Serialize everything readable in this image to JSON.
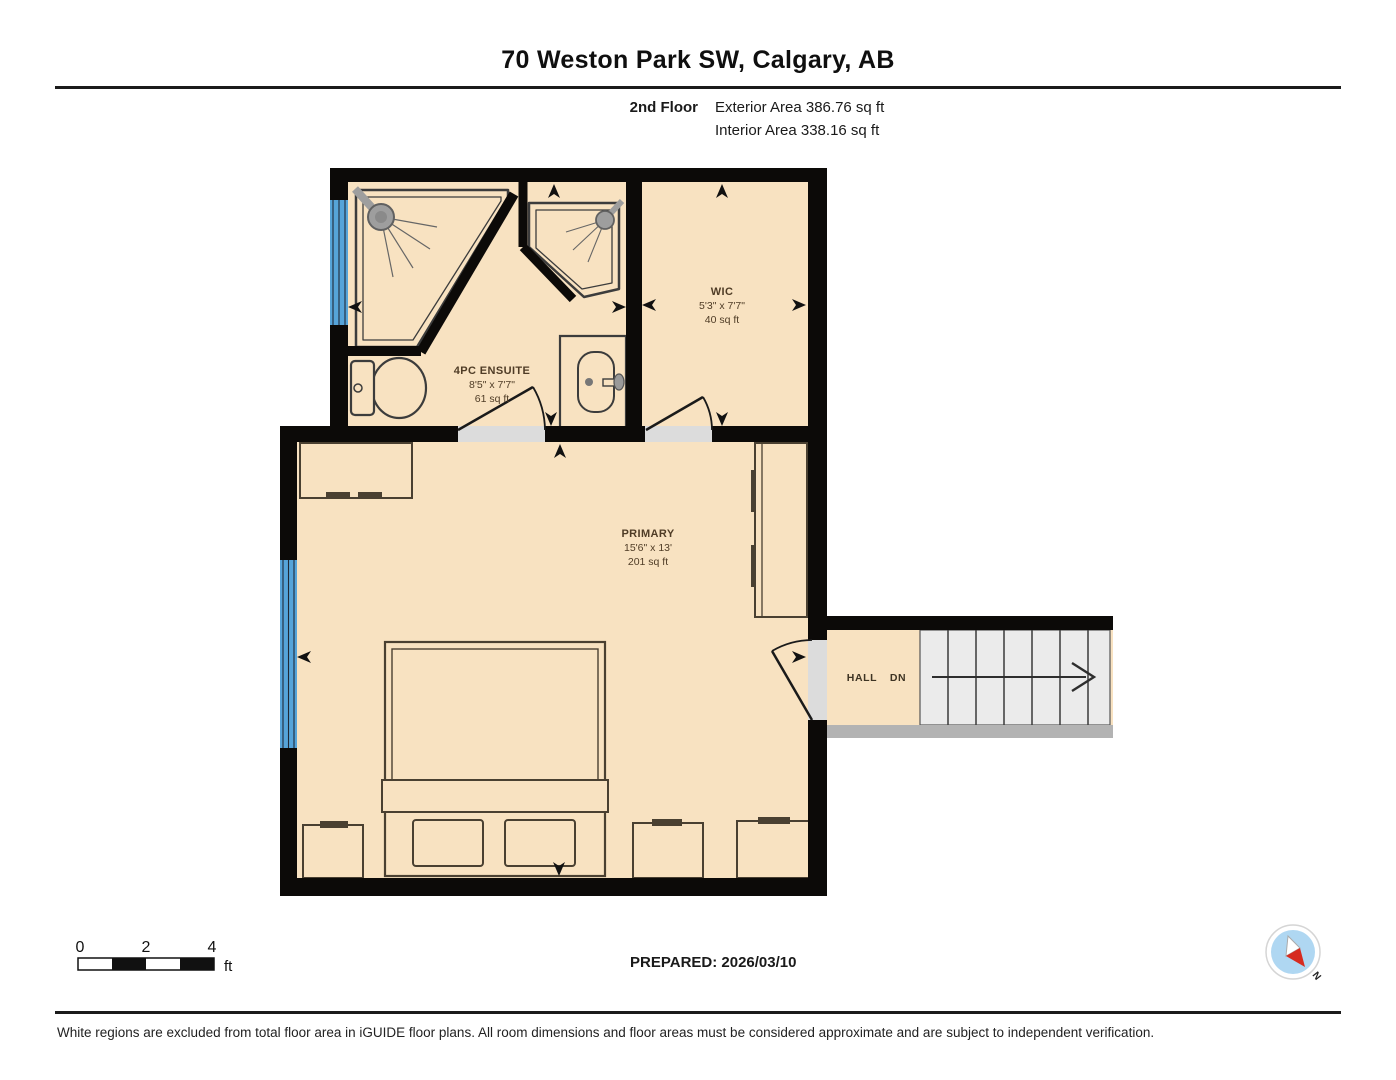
{
  "header": {
    "title": "70 Weston Park SW, Calgary, AB",
    "floor_label": "2nd Floor",
    "exterior_area": "Exterior Area 386.76 sq ft",
    "interior_area": "Interior Area 338.16 sq ft"
  },
  "rooms": {
    "ensuite": {
      "name": "4PC ENSUITE",
      "dimensions": "8'5\" x 7'7\"",
      "area": "61 sq ft"
    },
    "wic": {
      "name": "WIC",
      "dimensions": "5'3\" x 7'7\"",
      "area": "40 sq ft"
    },
    "primary": {
      "name": "PRIMARY",
      "dimensions": "15'6\" x 13'",
      "area": "201 sq ft"
    },
    "hall": {
      "name": "HALL"
    },
    "stairs": {
      "direction_label": "DN"
    }
  },
  "scale_bar": {
    "tick_0": "0",
    "tick_2": "2",
    "tick_4": "4",
    "unit": "ft"
  },
  "compass": {
    "north_label": "N"
  },
  "footer": {
    "prepared": "PREPARED: 2026/03/10",
    "disclaimer": "White regions are excluded from total floor area in iGUIDE floor plans. All room dimensions and floor areas must be considered approximate and are subject to independent verification."
  },
  "colors": {
    "room_fill": "#F8E2C1",
    "wall": "#0c0a08",
    "window_blue": "#56A4D9",
    "stairs_fill": "#EBEBEB",
    "threshold": "#DCDCDC",
    "compass_blue": "#AFD7F2",
    "compass_red": "#D62B20"
  }
}
